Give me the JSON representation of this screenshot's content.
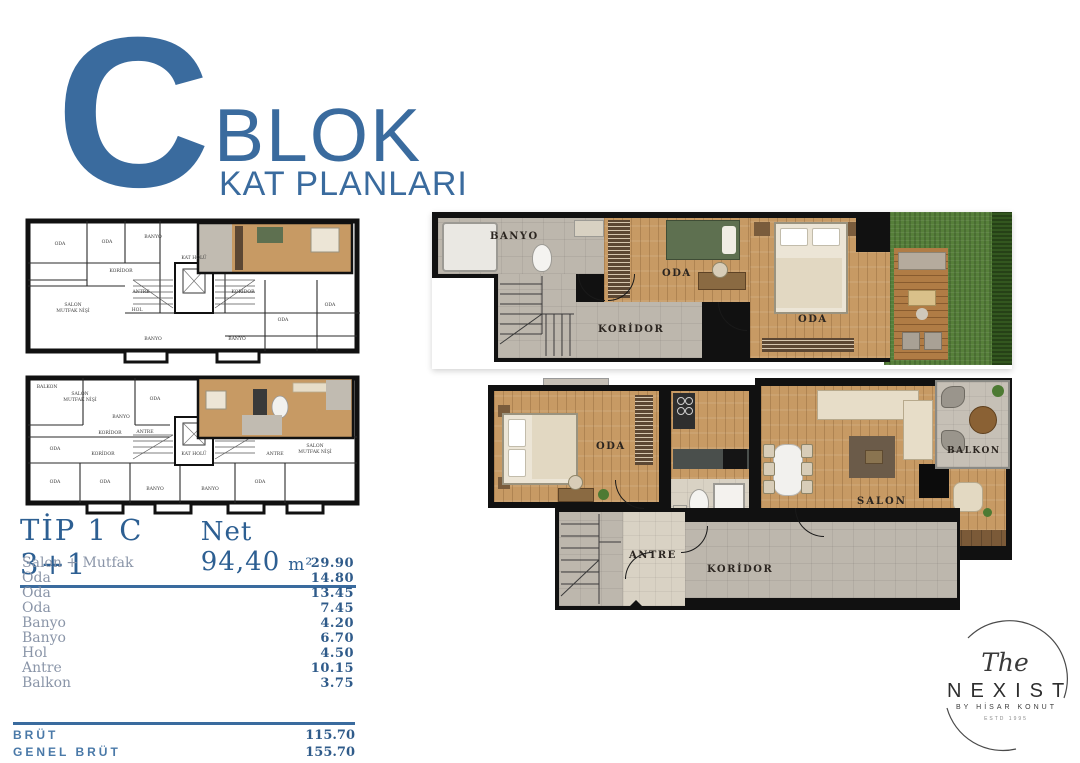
{
  "header": {
    "letter": "C",
    "title": "BLOK",
    "subtitle": "KAT PLANLARI",
    "accent_color": "#3a6b9e"
  },
  "unit_plans": {
    "upper": {
      "banyo": "BANYO",
      "oda1": "ODA",
      "oda2": "ODA",
      "koridor": "KORİDOR"
    },
    "lower": {
      "oda": "ODA",
      "banyo": "BANYO",
      "antre": "ANTRE",
      "koridor": "KORİDOR",
      "salon1": "SALON",
      "salon2": "MUTFAK NİŞİ",
      "balkon": "BALKON"
    }
  },
  "key_plan_labels": {
    "oda": "ODA",
    "banyo": "BANYO",
    "koridor": "KORİDOR",
    "antre": "ANTRE",
    "hol": "HOL",
    "kat_holu": "KAT HOLÜ",
    "salon1": "SALON",
    "salon2": "MUTFAK NİŞİ",
    "balkon": "BALKON"
  },
  "area_table": {
    "type_label": "TİP 1 C 3+1",
    "net_label": "Net 94,40",
    "net_unit": "m²",
    "rows": [
      {
        "name": "Salon + Mutfak",
        "value": "29.90"
      },
      {
        "name": "Oda",
        "value": "14.80"
      },
      {
        "name": "Oda",
        "value": "13.45"
      },
      {
        "name": "Oda",
        "value": "7.45"
      },
      {
        "name": "Banyo",
        "value": "4.20"
      },
      {
        "name": "Banyo",
        "value": "6.70"
      },
      {
        "name": "Hol",
        "value": "4.50"
      },
      {
        "name": "Antre",
        "value": "10.15"
      },
      {
        "name": "Balkon",
        "value": "3.75"
      }
    ],
    "totals": [
      {
        "name": "BRÜT",
        "value": "115.70"
      },
      {
        "name": "GENEL BRÜT",
        "value": "155.70"
      }
    ]
  },
  "logo": {
    "script": "The",
    "name": "NEXIST",
    "byline": "BY HİSAR KONUT",
    "estd": "ESTD 1995"
  }
}
